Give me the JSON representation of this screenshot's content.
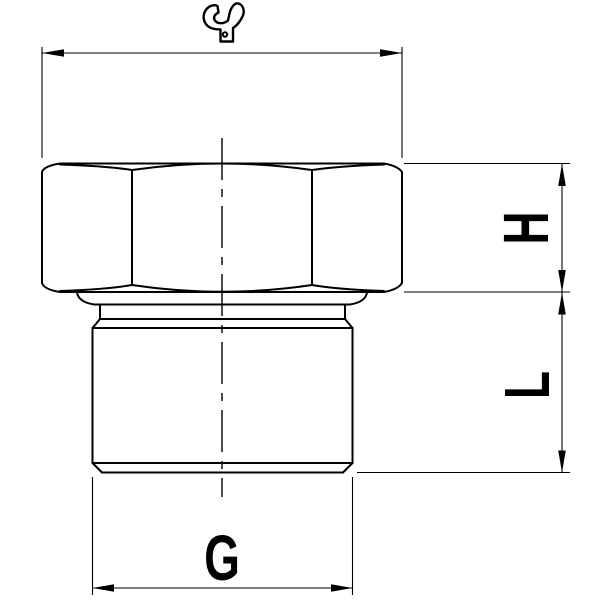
{
  "drawing": {
    "background_color": "#ffffff",
    "line_color": "#000000",
    "view": "threaded-hex-adapter-side-view",
    "dimension_labels": {
      "hex_height": "H",
      "thread_length": "L",
      "thread_size": "G"
    },
    "icons": [
      {
        "name": "wrench-icon"
      }
    ]
  }
}
